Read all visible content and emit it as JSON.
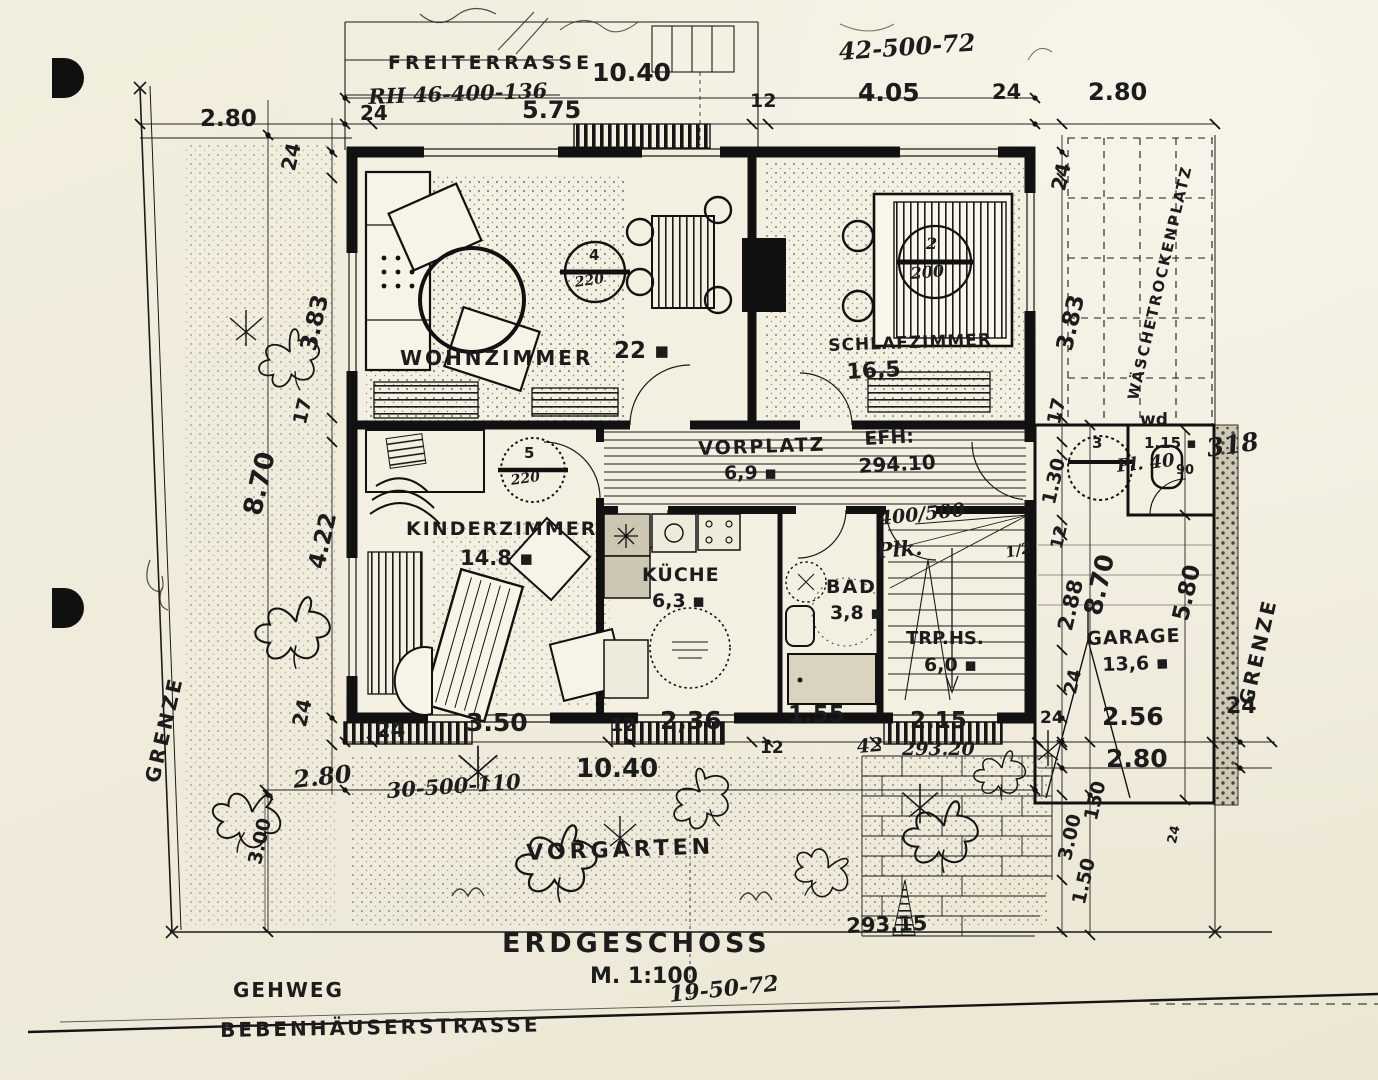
{
  "title_block": {
    "title": "ERDGESCHOSS",
    "scale": "M. 1:100"
  },
  "site": {
    "street": "BEBENHÄUSERSTRASSE",
    "sidewalk": "GEHWEG",
    "front_garden": "VORGARTEN",
    "terrace": "FREITERRASSE",
    "drying_place": "WÄSCHETROCKENPLATZ",
    "boundary_left": "GRENZE",
    "boundary_right": "GRENZE"
  },
  "rooms": {
    "wohnzimmer": {
      "name": "WOHNZIMMER",
      "area": "22 ▪"
    },
    "schlafzimmer": {
      "name": "SCHLAFZIMMER",
      "area": "16,5"
    },
    "kinderzimmer": {
      "name": "KINDERZIMMER",
      "area": "14.8 ▪"
    },
    "kueche": {
      "name": "KÜCHE",
      "area": "6,3 ▪"
    },
    "bad": {
      "name": "BAD",
      "area": "3,8 ▪"
    },
    "vorplatz": {
      "name": "VORPLATZ",
      "area": "6,9 ▪"
    },
    "treppenhaus": {
      "name": "TRP.HS.",
      "area": "6,0 ▪"
    },
    "garage": {
      "name": "GARAGE",
      "area": "13,6 ▪"
    },
    "wc": {
      "name": "wd",
      "area": "1.15 ▪",
      "door_angle": "90"
    }
  },
  "markers": {
    "wohnzimmer_no": "4",
    "wohnzimmer_val": "220",
    "schlafzimmer_no": "2",
    "schlafzimmer_val": "200",
    "kinderzimmer_no": "5",
    "kinderzimmer_val": "220",
    "garage_no": "3"
  },
  "dims": {
    "top": {
      "d1040": "10.40",
      "d575": "5.75",
      "d12": "12",
      "d405": "4.05",
      "d24a": "24",
      "d280": "2.80",
      "d24b": "24",
      "d280l": "2.80"
    },
    "left": {
      "d24a": "24",
      "d383": "3.83",
      "d17": "17",
      "d870": "8.70",
      "d422": "4.22",
      "d24b": "24",
      "d300": "3.00"
    },
    "right": {
      "d24a": "24",
      "d383": "3.83",
      "d17": "17",
      "d130": "1.30",
      "d12": "12",
      "d288": "2.88",
      "d870": "8.70",
      "d24b": "24",
      "d580": "5.80"
    },
    "bottom": {
      "d24a": "24",
      "d350": "3.50",
      "d12a": "12",
      "d236": "2,36",
      "d155": "1.55",
      "d12b": "12",
      "d215": "2.15",
      "d24b": "24",
      "d256": "2.56",
      "d24c": "24",
      "d150": "150",
      "d280": "2.80",
      "d300": "3.00",
      "d150b": "1.50",
      "d24d": "24",
      "d1040": "10.40"
    }
  },
  "annotations": {
    "top_left": "RH 46-400-136",
    "top_right": "42-500-72",
    "bottom_left": "30-500-110",
    "bottom_right": "19-50-72",
    "stair_size": "400/500",
    "stair_plk": "Plk.",
    "stair_half": "1/2",
    "elev_318": "318",
    "elev_293_20": "293.20",
    "elev_293_15": "293.15",
    "efh_label": "EFH:",
    "efh_value": "294.10",
    "hand_42": "42",
    "hand_280_bottom": "2.80",
    "garage_note": "Pl. 40"
  }
}
